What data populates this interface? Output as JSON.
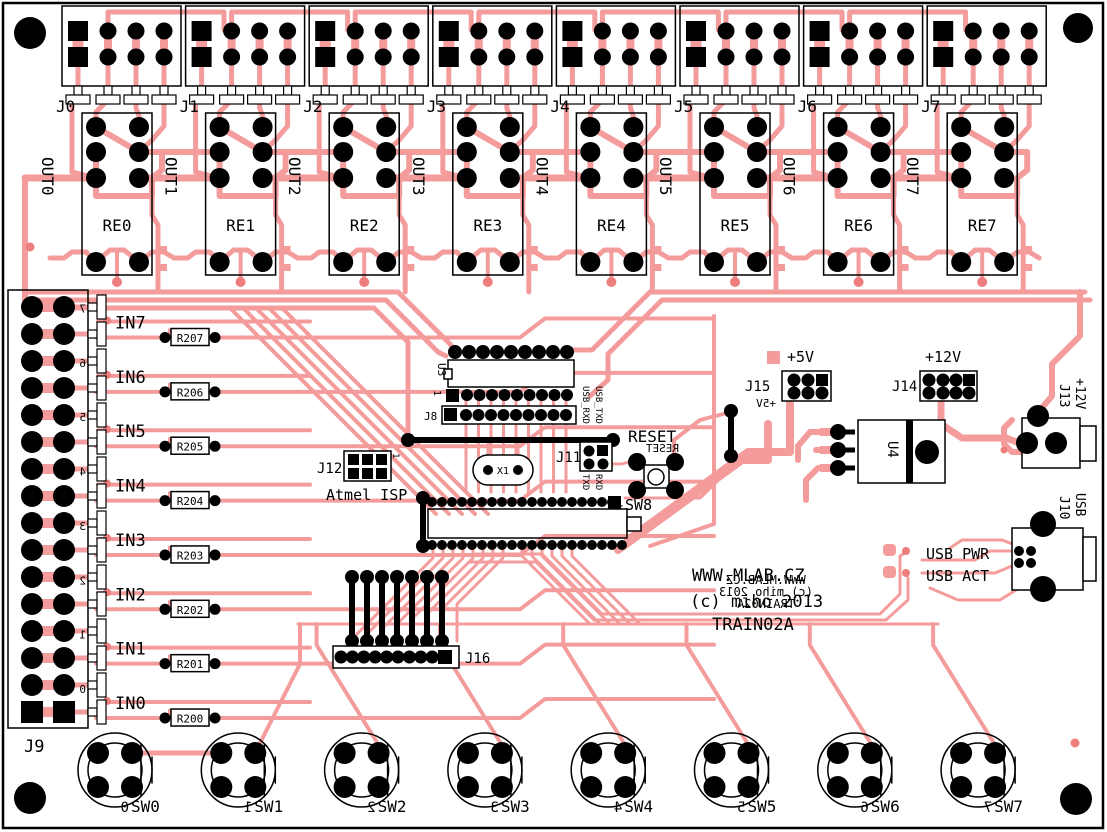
{
  "board_name": "TRAIN02A",
  "colors": {
    "copper": "#f49c9c",
    "silk": "#000000",
    "mirror_text": "#ee7d7d",
    "board": "#ffffff"
  },
  "relay_units": [
    {
      "connector": "J0",
      "relay": "RE0",
      "out": "OUT0"
    },
    {
      "connector": "J1",
      "relay": "RE1",
      "out": "OUT1"
    },
    {
      "connector": "J2",
      "relay": "RE2",
      "out": "OUT2"
    },
    {
      "connector": "J3",
      "relay": "RE3",
      "out": "OUT3"
    },
    {
      "connector": "J4",
      "relay": "RE4",
      "out": "OUT4"
    },
    {
      "connector": "J5",
      "relay": "RE5",
      "out": "OUT5"
    },
    {
      "connector": "J6",
      "relay": "RE6",
      "out": "OUT6"
    },
    {
      "connector": "J7",
      "relay": "RE7",
      "out": "OUT7"
    }
  ],
  "inputs": [
    {
      "label": "IN7",
      "resistor": "R207",
      "digit": "7"
    },
    {
      "label": "IN6",
      "resistor": "R206",
      "digit": "6"
    },
    {
      "label": "IN5",
      "resistor": "R205",
      "digit": "5"
    },
    {
      "label": "IN4",
      "resistor": "R204",
      "digit": "4"
    },
    {
      "label": "IN3",
      "resistor": "R203",
      "digit": "3"
    },
    {
      "label": "IN2",
      "resistor": "R202",
      "digit": "2"
    },
    {
      "label": "IN1",
      "resistor": "R201",
      "digit": "1"
    },
    {
      "label": "IN0",
      "resistor": "R200",
      "digit": "0"
    }
  ],
  "input_connector": {
    "ref": "J9"
  },
  "switches": [
    {
      "label": "SW0",
      "digit": "0"
    },
    {
      "label": "SW1",
      "digit": "1"
    },
    {
      "label": "SW2",
      "digit": "2"
    },
    {
      "label": "SW3",
      "digit": "3"
    },
    {
      "label": "SW4",
      "digit": "4"
    },
    {
      "label": "SW5",
      "digit": "5"
    },
    {
      "label": "SW6",
      "digit": "6"
    },
    {
      "label": "SW7",
      "digit": "7"
    }
  ],
  "ic_u3": {
    "ref": "U3",
    "pin1": "1",
    "header": "J8"
  },
  "isp": {
    "ref": "J12",
    "pin1": "1",
    "caption": "Atmel ISP"
  },
  "crystal": {
    "ref": "X1"
  },
  "serial_header": {
    "ref": "J11",
    "top_labels": [
      "USB_RXD",
      "USB_TXD"
    ],
    "bottom_labels": [
      "TXD",
      "RXD"
    ]
  },
  "reset": {
    "caption": "RESET",
    "mirrored_caption": "RESET",
    "button_ref": "-SW8"
  },
  "aux_header": {
    "ref": "J16"
  },
  "power_5v": {
    "ref": "J15",
    "rail": "+5V",
    "mirrored_rail": "+5V"
  },
  "power_12v": {
    "ref": "J14",
    "rail": "+12V"
  },
  "regulator": {
    "ref": "U4"
  },
  "dc_jack": {
    "ref": "J13",
    "rail": "+12V"
  },
  "usb": {
    "ref": "J10",
    "type": "USB",
    "pwr_label": "USB PWR",
    "act_label": "USB ACT"
  },
  "titleblock": {
    "line1": "WWW.MLAB.CZ",
    "line2": "(c) miho 2013",
    "line3": "TRAIN02A",
    "mirrored_lines": [
      "WWW.MLAB.CZ",
      "(c) miho 2013",
      "TRAIN02A"
    ]
  }
}
